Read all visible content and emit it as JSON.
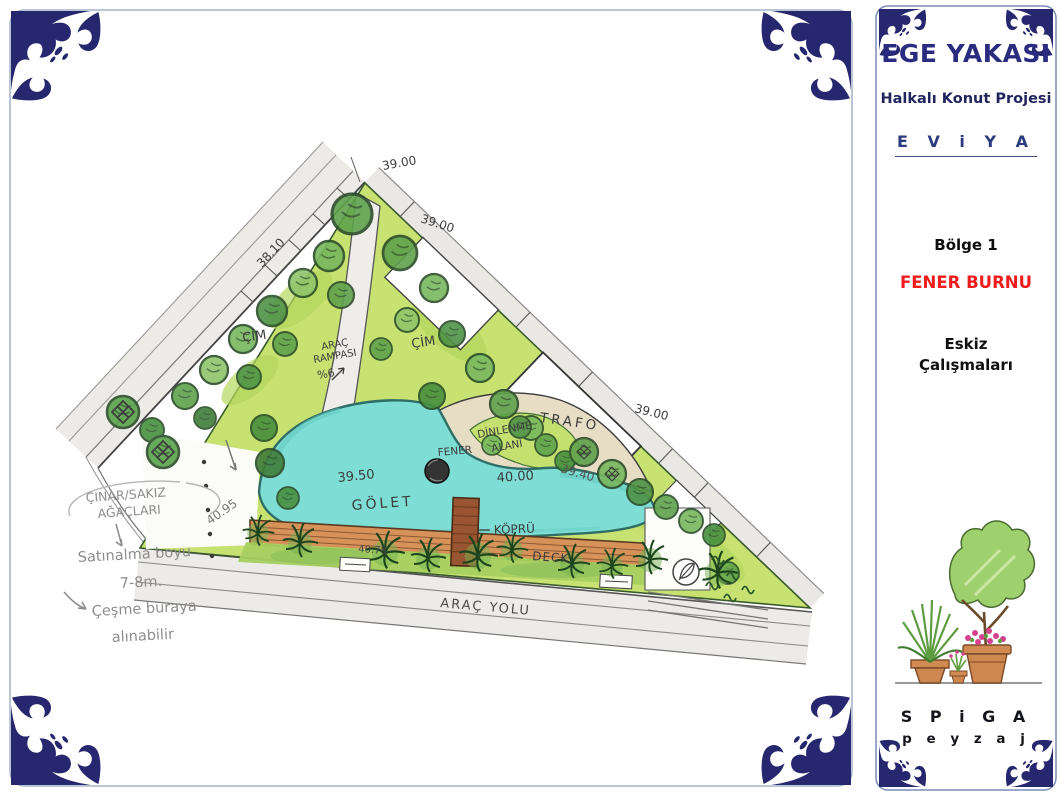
{
  "sidebar": {
    "title": "EGE YAKASI",
    "subtitle": "Halkalı Konut Projesi",
    "brand": "E V i Y A",
    "region": "Bölge 1",
    "zone_name": "FENER BURNU",
    "phase_line1": "Eskiz",
    "phase_line2": "Çalışmaları",
    "logo_name": "S P i G A",
    "logo_tagline": "p e y z a j"
  },
  "plan": {
    "labels": {
      "elev_top1": "39.00",
      "elev_top2": "39.00",
      "elev_left": "38.10",
      "elev_right": "39.00",
      "elev_mid": "39.40",
      "elev_pond": "39.50",
      "elev_rest_area": "40.00",
      "elev_road": "40.95",
      "elev_deck": "40.78",
      "grass_left": "ÇİM",
      "grass_right": "ÇİM",
      "ramp_line1": "ARAÇ",
      "ramp_line2": "RAMPASI",
      "ramp_line3": "%6",
      "trafo": "TRAFO",
      "rest_line1": "DİNLENME",
      "rest_line2": "ALANI",
      "lantern": "FENER",
      "pond": "GÖLET",
      "bridge": "KÖPRÜ",
      "deck": "DECK",
      "road": "ARAÇ YOLU"
    },
    "notes": {
      "trees_line1": "ÇINAR/SAKIZ",
      "trees_line2": "AĞAÇLARI",
      "height_line1": "Satınalma boyu",
      "height_line2": "7-8m.",
      "fountain_line1": "Çeşme buraya",
      "fountain_line2": "alınabilir"
    }
  },
  "colors": {
    "frame_navy": "#27276f",
    "title_navy": "#2b2b80",
    "zone_red": "#ee1c1c",
    "pond_teal": "#7eddd4",
    "lawn_green": "#c8e272",
    "deck_brown": "#d7925a"
  }
}
